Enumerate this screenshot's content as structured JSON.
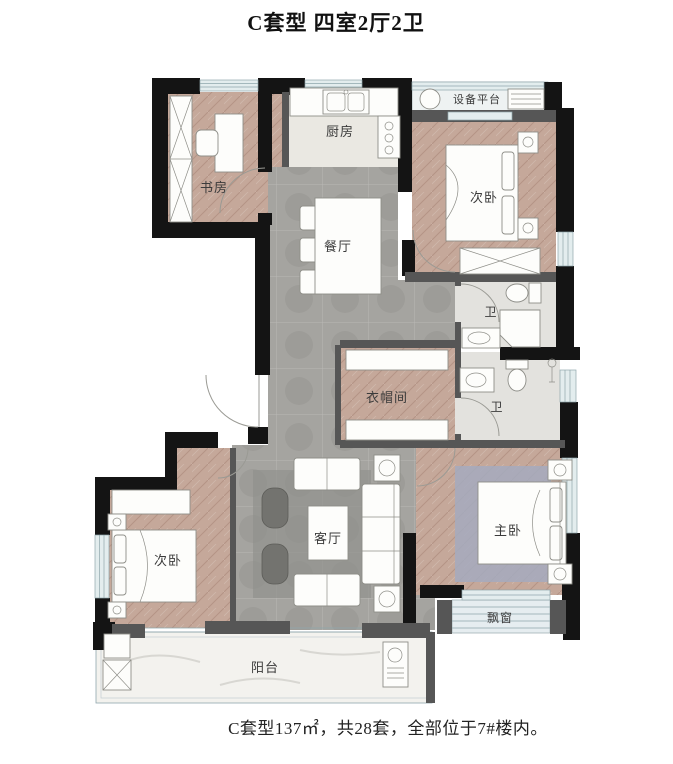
{
  "title": "C套型 四室2厅2卫",
  "caption": "C套型137㎡，共28套，全部位于7#楼内。",
  "rooms": {
    "study": {
      "label": "书房"
    },
    "kitchen": {
      "label": "厨房"
    },
    "equipment_platform": {
      "label": "设备平台"
    },
    "bedroom_top": {
      "label": "次卧"
    },
    "dining": {
      "label": "餐厅"
    },
    "bath_upper": {
      "label": "卫"
    },
    "bath_lower": {
      "label": "卫"
    },
    "closet": {
      "label": "衣帽间"
    },
    "living": {
      "label": "客厅"
    },
    "bedroom_left": {
      "label": "次卧"
    },
    "master": {
      "label": "主卧"
    },
    "bay_window": {
      "label": "飘窗"
    },
    "balcony": {
      "label": "阳台"
    }
  },
  "colors": {
    "wall_black": "#141414",
    "gray_wall": "#565656",
    "wood_floor": "#c5a89a",
    "tile_floor": "#a5a4a0",
    "kitchen_floor": "#eae8e2",
    "bath_floor": "#e3e2de",
    "balcony_floor": "#f3f2ee",
    "window_glass": "#e3edee",
    "window_frame": "#8fa6ac",
    "furniture_stroke": "#8e8e88",
    "label_text": "#3b3b3b",
    "master_rug": "#a4aabe",
    "living_rug": "#8f908c"
  }
}
